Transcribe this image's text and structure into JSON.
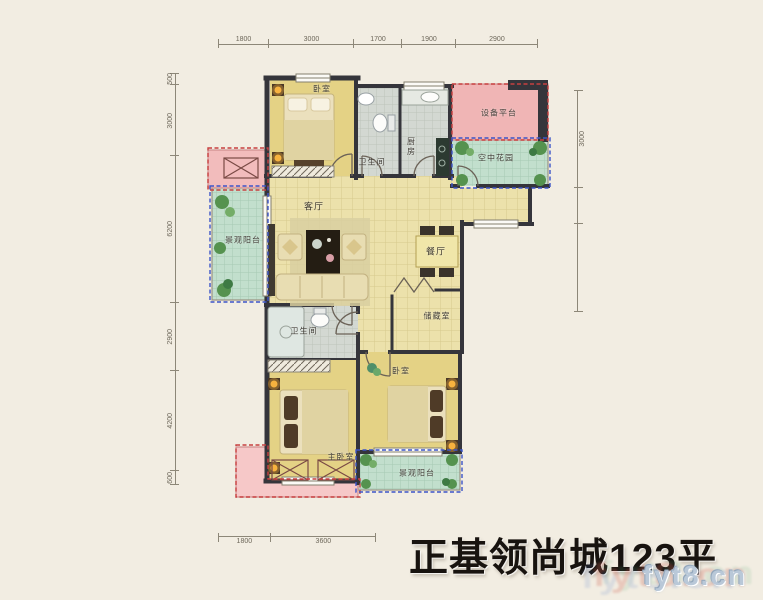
{
  "title": "正基领尚城123平",
  "watermark": {
    "text": "fyt8.cn"
  },
  "rooms": {
    "bedroom_top": "卧室",
    "bathroom_top": "卫生间",
    "kitchen": "厨房",
    "equipment_platform": "设备平台",
    "sky_garden": "空中花园",
    "balcony_left": "景观阳台",
    "living_room": "客厅",
    "dining_room": "餐厅",
    "storage_room": "储藏室",
    "bathroom_bottom": "卫生间",
    "master_bedroom": "主卧室",
    "bedroom_bottom": "卧室",
    "balcony_bottom": "景观阳台"
  },
  "dimensions": {
    "top": [
      "1800",
      "3000",
      "1700",
      "1900",
      "2900"
    ],
    "left": [
      "500",
      "3000",
      "6200",
      "2900",
      "4200",
      "600"
    ],
    "right": [
      "3000",
      "",
      ""
    ],
    "bottom": [
      "1800",
      "3600"
    ]
  }
}
